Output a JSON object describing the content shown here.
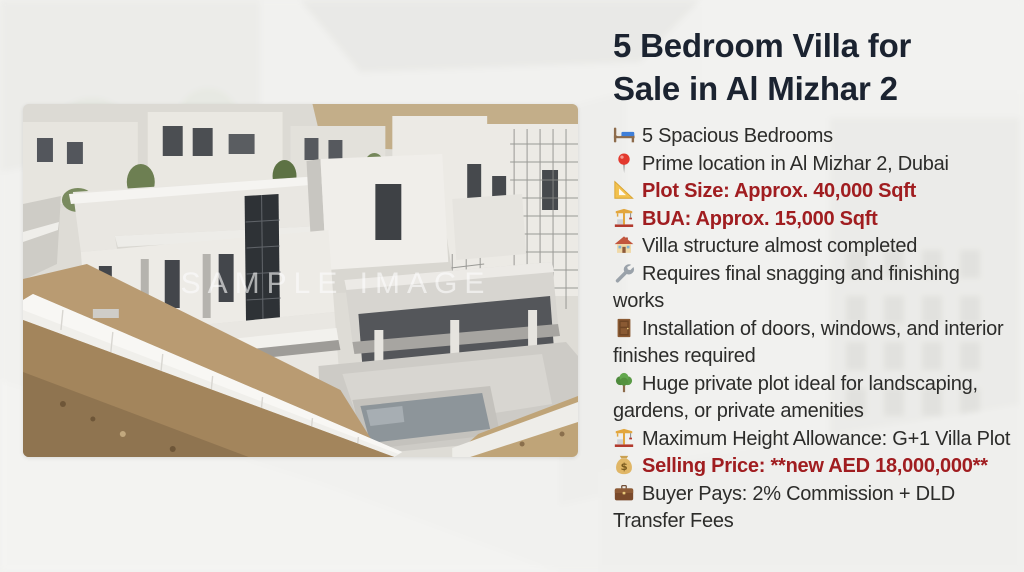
{
  "listing": {
    "title": "5 Bedroom Villa for Sale in Al Mizhar 2",
    "details": [
      {
        "icon": "bed-icon",
        "text": "5 Spacious Bedrooms",
        "emphasis": false
      },
      {
        "icon": "pin-icon",
        "text": "Prime location in Al Mizhar 2, Dubai",
        "emphasis": false
      },
      {
        "icon": "triangular-ruler-icon",
        "text": "Plot Size: Approx. 40,000 Sqft",
        "emphasis": true
      },
      {
        "icon": "construction-crane-icon",
        "text": "BUA: Approx. 15,000 Sqft",
        "emphasis": true
      },
      {
        "icon": "house-icon",
        "text": "Villa structure almost completed",
        "emphasis": false
      },
      {
        "icon": "wrench-icon",
        "text": "Requires final snagging and finishing works",
        "emphasis": false
      },
      {
        "icon": "door-icon",
        "text": "Installation of doors, windows, and interior finishes required",
        "emphasis": false
      },
      {
        "icon": "tree-icon",
        "text": "Huge private plot ideal for landscaping, gardens, or private amenities",
        "emphasis": false
      },
      {
        "icon": "construction-crane-icon",
        "text": "Maximum Height Allowance: G+1 Villa Plot",
        "emphasis": false
      },
      {
        "icon": "money-bag-icon",
        "text": "Selling Price: **new AED 18,000,000**",
        "emphasis": true
      },
      {
        "icon": "briefcase-icon",
        "text": "Buyer Pays: 2% Commission + DLD Transfer Fees",
        "emphasis": false
      }
    ]
  },
  "photo": {
    "watermark": "SAMPLE IMAGE"
  },
  "colors": {
    "title": "#1b2330",
    "body": "#2c2c2a",
    "accent_red": "#a01d20"
  }
}
